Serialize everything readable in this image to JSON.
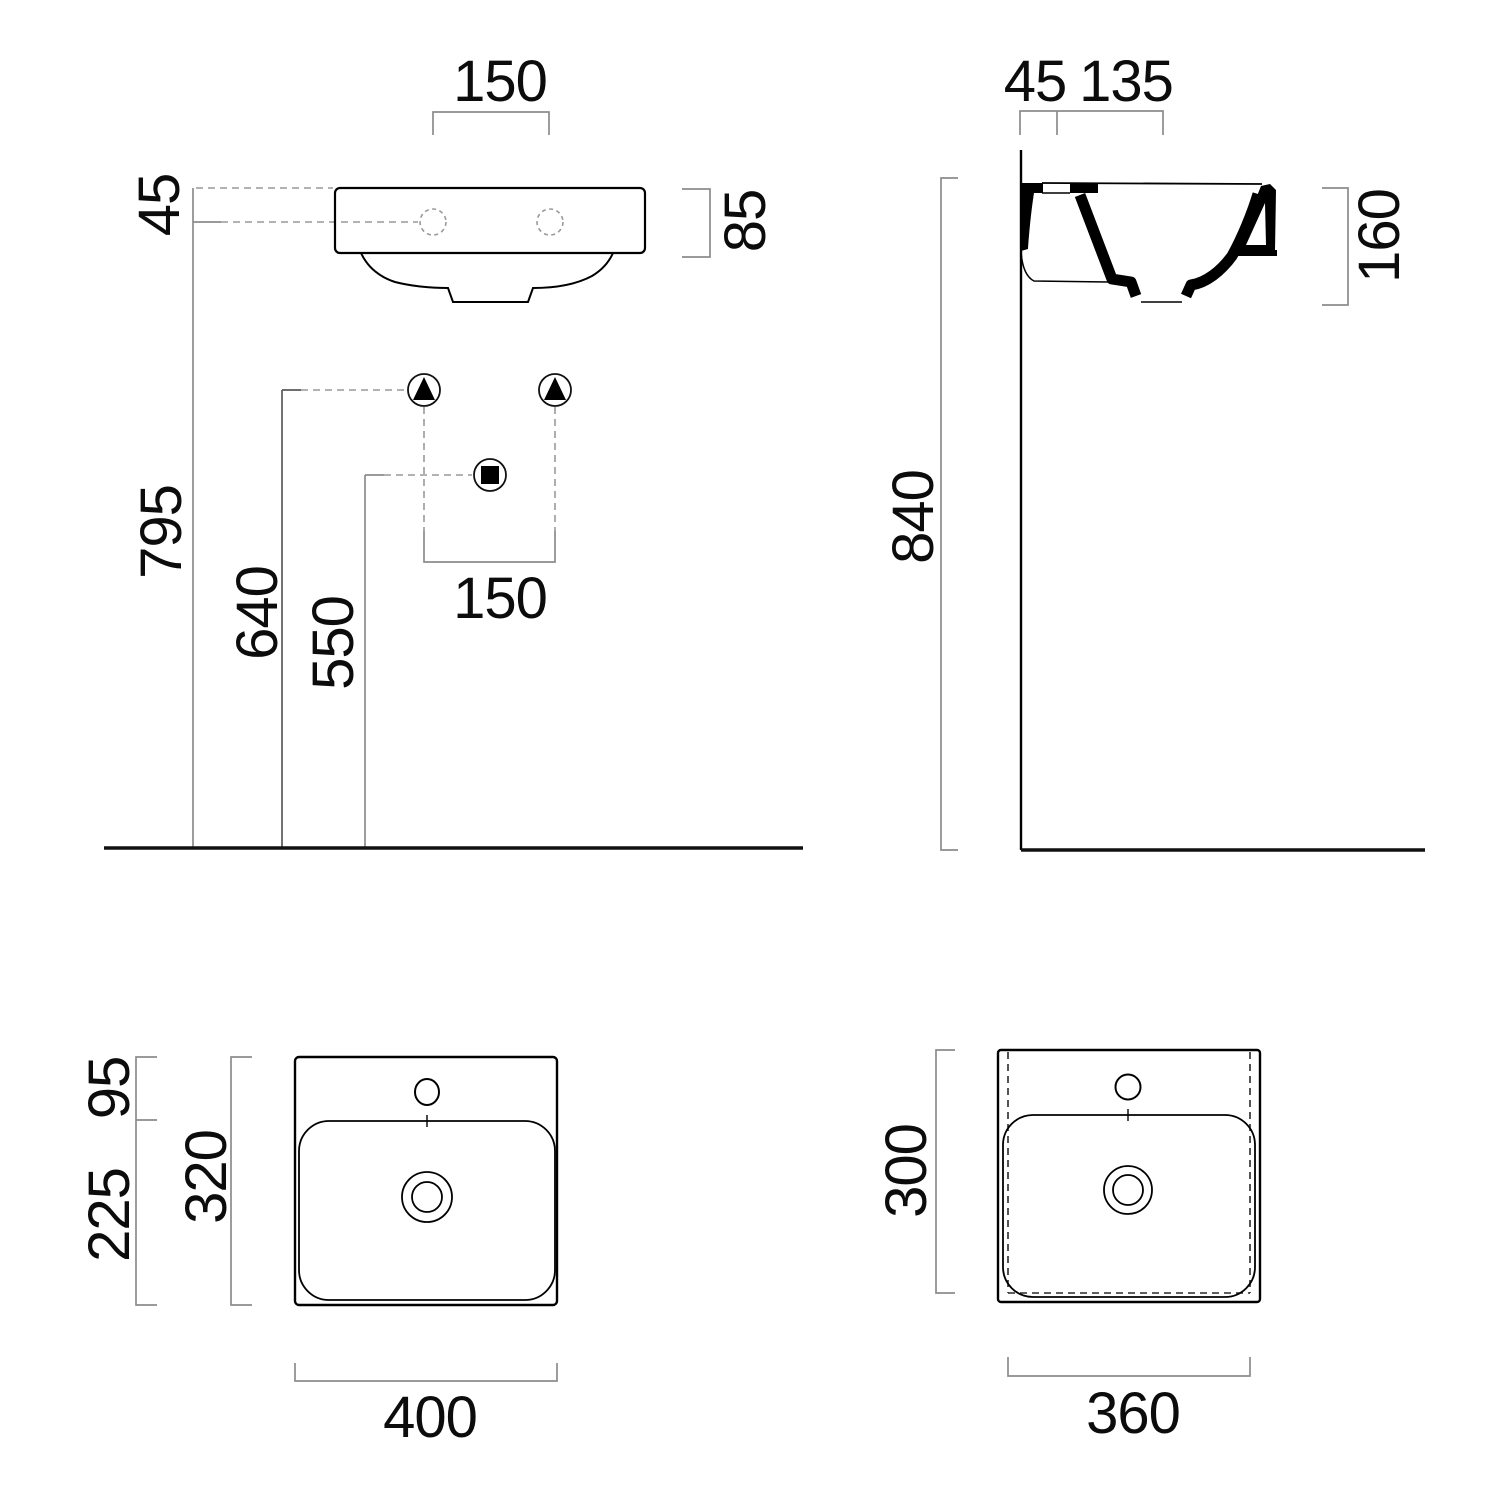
{
  "drawing_title": "washbasin-technical-dimension-drawing",
  "front": {
    "tap_spacing_top": "150",
    "rim_to_tap_offset": "45",
    "apron_height": "85",
    "tap_hole_height": "795",
    "fixing_bolt_height": "640",
    "waste_outlet_height": "550",
    "fixing_spacing_bottom": "150"
  },
  "side": {
    "wall_to_tap": "45",
    "tap_to_front": "135",
    "rim_floor_height": "840",
    "basin_section_height": "160"
  },
  "plan": {
    "back_deck_depth": "95",
    "bowl_depth": "225",
    "total_depth": "320",
    "total_width": "400"
  },
  "underside": {
    "total_depth": "300",
    "total_width": "360"
  },
  "colors": {
    "object_line": "#000000",
    "dimension_line": "#8c8c8c",
    "text": "#0c0c0c",
    "background": "#ffffff"
  }
}
